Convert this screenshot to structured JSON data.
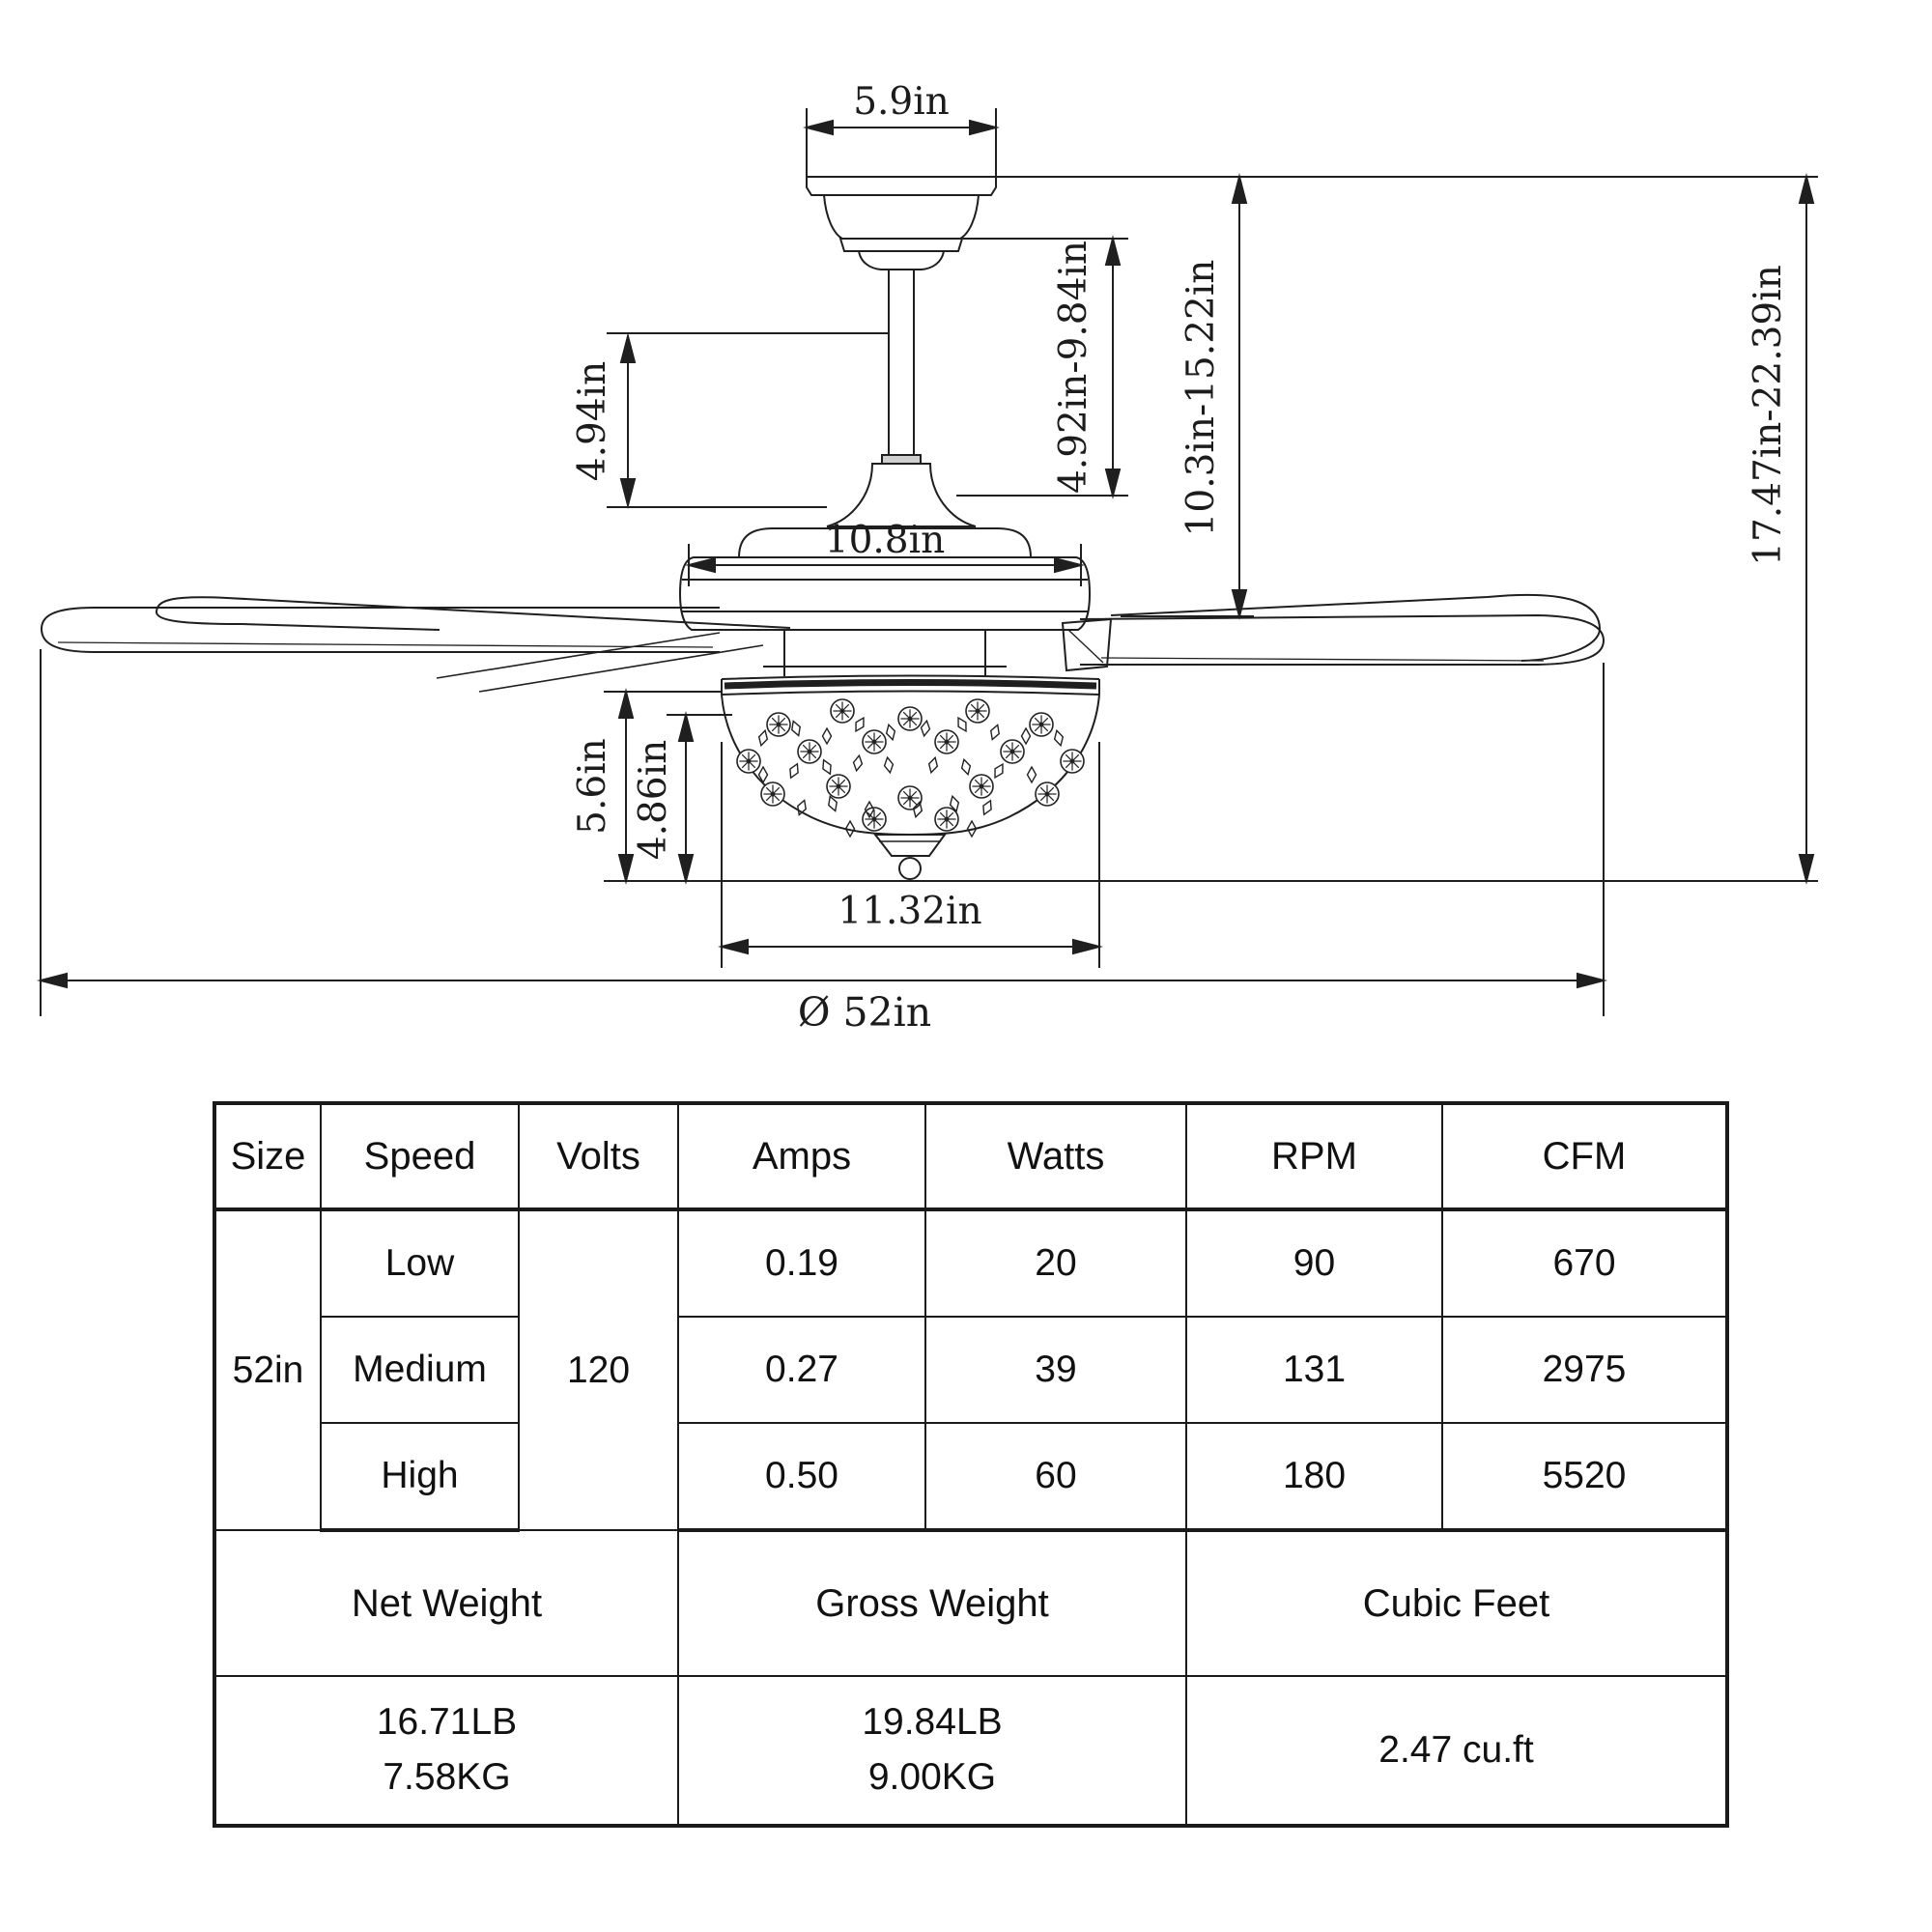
{
  "dims": {
    "canopy_width": "5.9in",
    "upper_height": "4.94in",
    "downrod_length": "4.92in-9.84in",
    "mid_height": "10.3in-15.22in",
    "total_height": "17.47in-22.39in",
    "motor_width": "10.8in",
    "light_height_outer": "5.6in",
    "light_height_inner": "4.86in",
    "light_width": "11.32in",
    "blade_diameter": "Ø 52in"
  },
  "table": {
    "headers": [
      "Size",
      "Speed",
      "Volts",
      "Amps",
      "Watts",
      "RPM",
      "CFM"
    ],
    "size": "52in",
    "volts": "120",
    "rows": [
      {
        "speed": "Low",
        "amps": "0.19",
        "watts": "20",
        "rpm": "90",
        "cfm": "670"
      },
      {
        "speed": "Medium",
        "amps": "0.27",
        "watts": "39",
        "rpm": "131",
        "cfm": "2975"
      },
      {
        "speed": "High",
        "amps": "0.50",
        "watts": "60",
        "rpm": "180",
        "cfm": "5520"
      }
    ],
    "weight_headers": [
      "Net Weight",
      "Gross Weight",
      "Cubic Feet"
    ],
    "net_weight_lb": "16.71LB",
    "net_weight_kg": "7.58KG",
    "gross_weight_lb": "19.84LB",
    "gross_weight_kg": "9.00KG",
    "cubic_feet": "2.47 cu.ft"
  }
}
